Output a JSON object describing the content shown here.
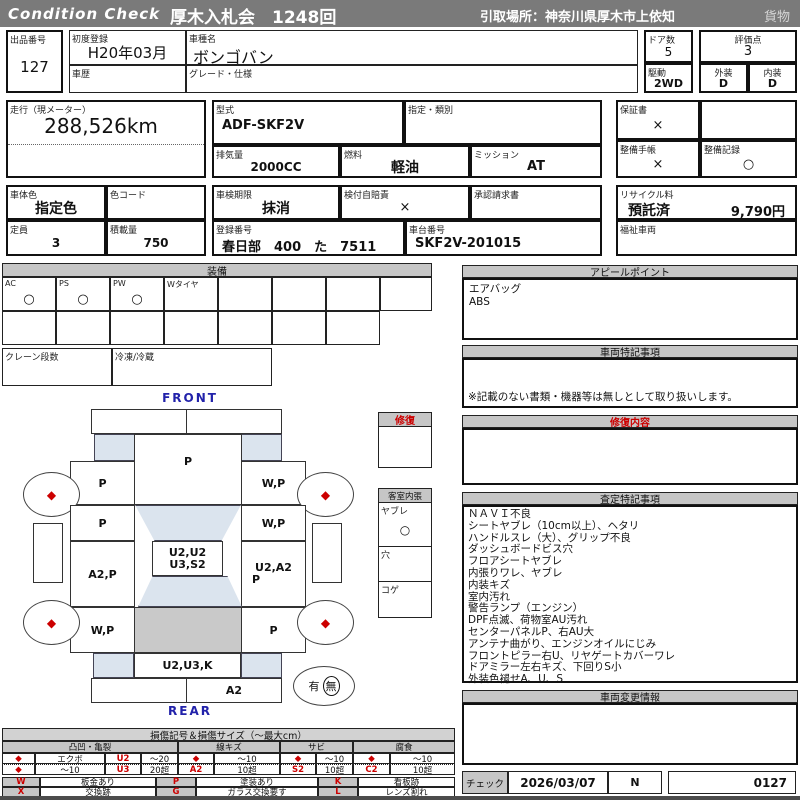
{
  "header": {
    "brand": "Condition  Check",
    "auction": "厚木入札会　1248回",
    "pickup": "引取場所：神奈川県厚木市上依知",
    "category": "貨物"
  },
  "info": {
    "lot_label": "出品番号",
    "lot_no": "127",
    "first_reg_label": "初度登録",
    "first_reg": "H20年03月",
    "model_name_label": "車種名",
    "model_name": "ボンゴバン",
    "history_label": "車歴",
    "grade_label": "グレード・仕様",
    "doors_label": "ドア数",
    "doors": "5",
    "score_label": "評価点",
    "score": "3",
    "drive_label": "駆動",
    "drive": "2WD",
    "exterior_label": "外装",
    "exterior": "D",
    "interior_label": "内装",
    "interior": "D"
  },
  "meter": {
    "label": "走行（現メーター）",
    "value": "288,526km"
  },
  "spec": {
    "model_code_label": "型式",
    "model_code": "ADF-SKF2V",
    "designation_label": "指定・類別",
    "displacement_label": "排気量",
    "displacement": "2000CC",
    "fuel_label": "燃料",
    "fuel": "軽油",
    "transmission_label": "ミッション",
    "transmission": "AT"
  },
  "docs": {
    "warranty_label": "保証書",
    "warranty": "×",
    "maintenance_book_label": "整備手帳",
    "maintenance_book": "×",
    "maintenance_record_label": "整備記録",
    "maintenance_record": "○"
  },
  "body": {
    "color_label": "車体色",
    "color": "指定色",
    "color_code_label": "色コード",
    "capacity_label": "定員",
    "capacity": "3",
    "load_label": "積載量",
    "load": "750"
  },
  "registration": {
    "inspection_label": "車検期限",
    "inspection": "抹消",
    "insurance_label": "検付自賠責",
    "insurance": "×",
    "approval_label": "承認請求書",
    "reg_no_label": "登録番号",
    "reg_no": "春日部　400　た　7511",
    "chassis_label": "車台番号",
    "chassis": "SKF2V-201015",
    "recycle_label": "リサイクル料",
    "recycle_status": "預託済",
    "recycle_fee": "9,790円",
    "welfare_label": "福祉車両"
  },
  "equipment": {
    "title": "装備",
    "items": [
      {
        "label": "AC",
        "mark": "○"
      },
      {
        "label": "PS",
        "mark": "○"
      },
      {
        "label": "PW",
        "mark": "○"
      },
      {
        "label": "Wタイヤ",
        "mark": ""
      },
      {
        "label": "",
        "mark": ""
      },
      {
        "label": "",
        "mark": ""
      },
      {
        "label": "",
        "mark": ""
      },
      {
        "label": "",
        "mark": ""
      }
    ],
    "crane_label": "クレーン段数",
    "fridge_label": "冷凍/冷蔵"
  },
  "appeal": {
    "title": "アピールポイント",
    "lines": [
      "エアバッグ",
      "ABS"
    ]
  },
  "vehicle_notes": {
    "title": "車両特記事項",
    "note": "※記載のない書類・機器等は無しとして取り扱いします。"
  },
  "repair": {
    "box_title": "修復",
    "content_title": "修復内容"
  },
  "cabin": {
    "title": "客室内張",
    "tear_label": "ヤブレ",
    "tear_mark": "○",
    "hole_label": "穴",
    "burn_label": "コゲ"
  },
  "assessment": {
    "title": "査定特記事項",
    "lines": [
      "ＮＡＶＩ不良",
      "シートヤブレ（10cm以上）、ヘタリ",
      "ハンドルスレ（大）、グリップ不良",
      "ダッシュボードビス穴",
      "フロアシートヤブレ",
      "内張りワレ、ヤブレ",
      "内装キズ",
      "室内汚れ",
      "警告ランプ（エンジン）",
      "DPF点滅、荷物室AU汚れ",
      "センターパネルP、右AU大",
      "アンテナ曲がり、エンジンオイルにじみ",
      "フロントピラー右U、リヤゲートカバーワレ",
      "ドアミラー左右キズ、下回りS小",
      "外装色褪せA、U、S"
    ]
  },
  "change_info": {
    "title": "車両変更情報"
  },
  "diagram": {
    "front_label": "FRONT",
    "rear_label": "REAR",
    "wheel_mark": "◆",
    "hood": "P",
    "front_left_fender": "P",
    "front_right_fender": "W,P",
    "front_left_door": "P",
    "front_right_door": "W,P",
    "roof_line1": "U2,U2",
    "roof_line2": "U3,S2",
    "mid_left": "A2,P",
    "mid_right_line1": "U2,A2",
    "mid_right_line2": "P",
    "rear_left": "W,P",
    "rear_right": "P",
    "rear_panel": "U2,U3,K",
    "rear_bumper": "A2",
    "spare_yes": "有",
    "spare_no": "無"
  },
  "legend": {
    "title": "損傷記号＆損傷サイズ（〜最大cm）",
    "groups": [
      "凸凹・亀裂",
      "線キズ",
      "サビ",
      "腐食"
    ],
    "row1": {
      "c1": "◆",
      "c2": "エクボ",
      "c3": "U2",
      "c4": "〜20",
      "c5": "◆",
      "c6": "〜10",
      "c7": "◆",
      "c8": "〜10",
      "c9": "◆",
      "c10": "〜10"
    },
    "row2": {
      "c1": "◆",
      "c2": "〜10",
      "c3": "U3",
      "c4": "20超",
      "c5": "A2",
      "c6": "10超",
      "c7": "S2",
      "c8": "10超",
      "c9": "C2",
      "c10": "10超"
    },
    "codes": [
      {
        "code": "W",
        "desc": "板金あり"
      },
      {
        "code": "X",
        "desc": "交換跡"
      },
      {
        "code": "P",
        "desc": "塗装あり"
      },
      {
        "code": "G",
        "desc": "ガラス交換要す"
      },
      {
        "code": "K",
        "desc": "看板跡"
      },
      {
        "code": "L",
        "desc": "レンズ割れ"
      }
    ]
  },
  "check": {
    "label": "チェック",
    "date": "2026/03/07",
    "inspector": "N",
    "number": "0127"
  }
}
